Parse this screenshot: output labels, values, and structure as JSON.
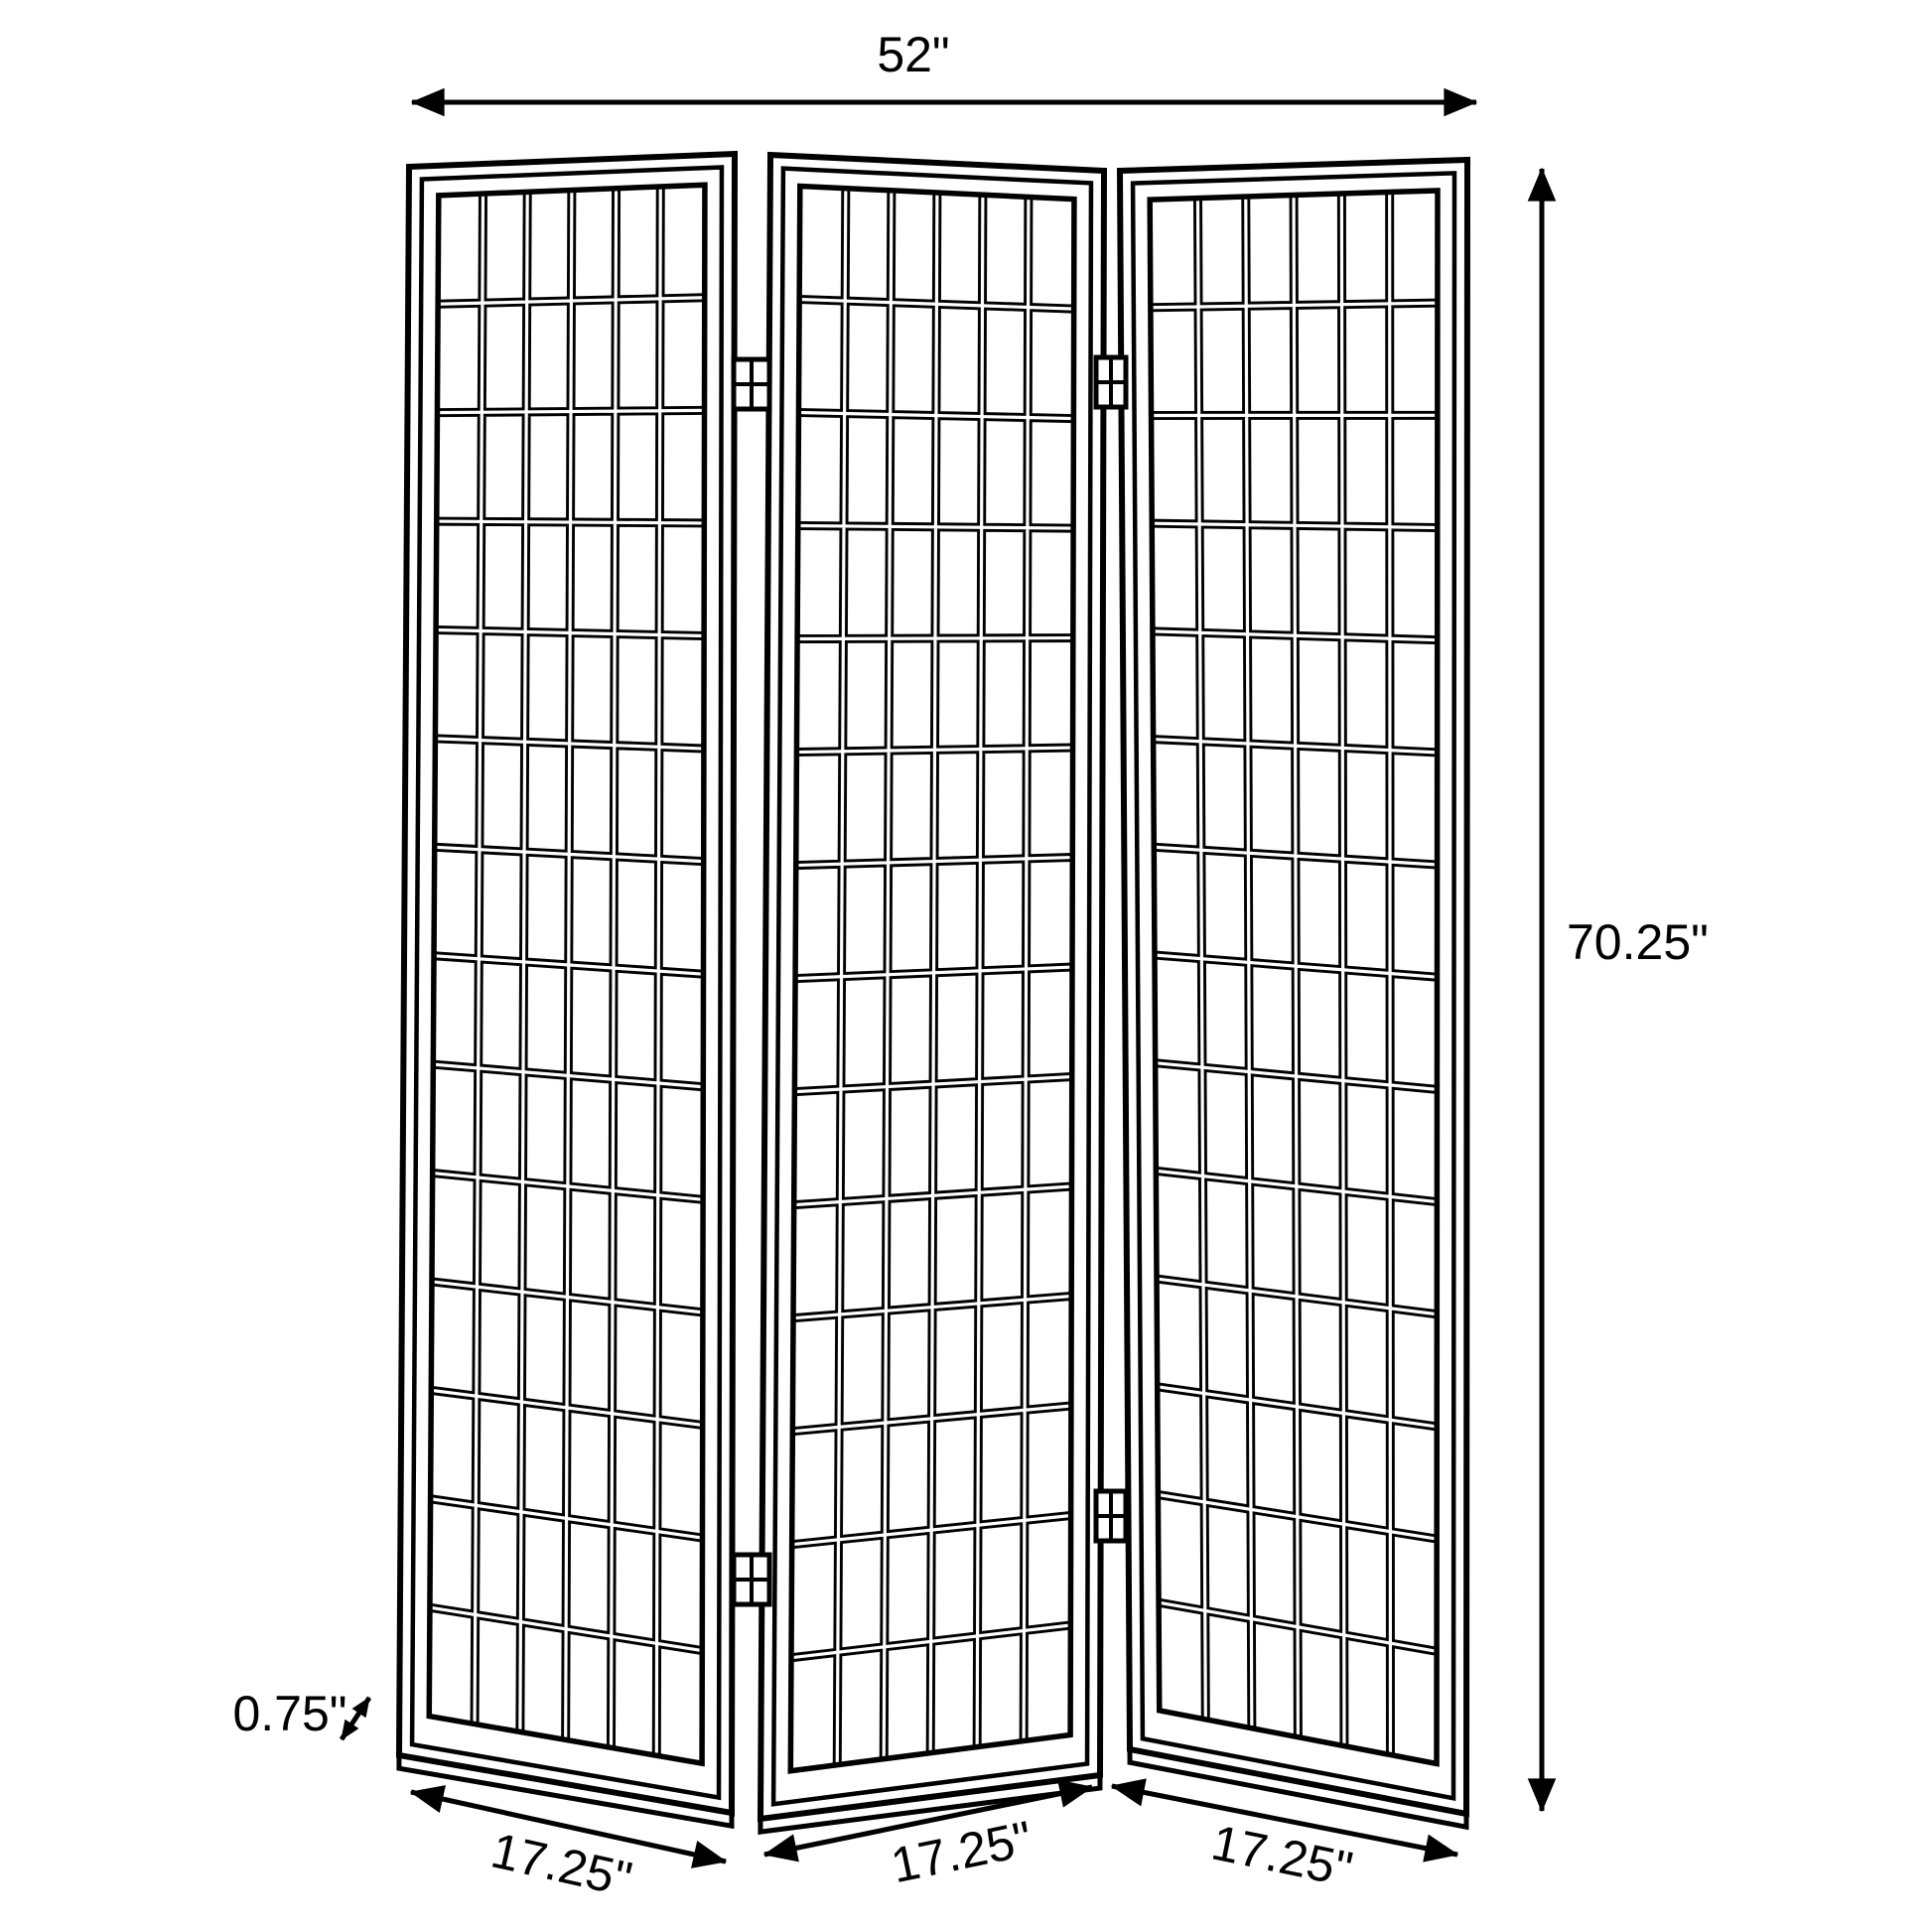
{
  "diagram": {
    "overall": {
      "width_label": "52\"",
      "height_label": "70.25\"",
      "depth_label": "0.75\""
    },
    "panels": [
      {
        "name": "left",
        "width_label": "17.25\"",
        "grid_cols": 6,
        "grid_rows": 14
      },
      {
        "name": "middle",
        "width_label": "17.25\"",
        "grid_cols": 6,
        "grid_rows": 14
      },
      {
        "name": "right",
        "width_label": "17.25\"",
        "grid_cols": 6,
        "grid_rows": 14
      }
    ],
    "panel_count": 3,
    "colors": {
      "line": "#000000",
      "background": "#ffffff"
    }
  }
}
